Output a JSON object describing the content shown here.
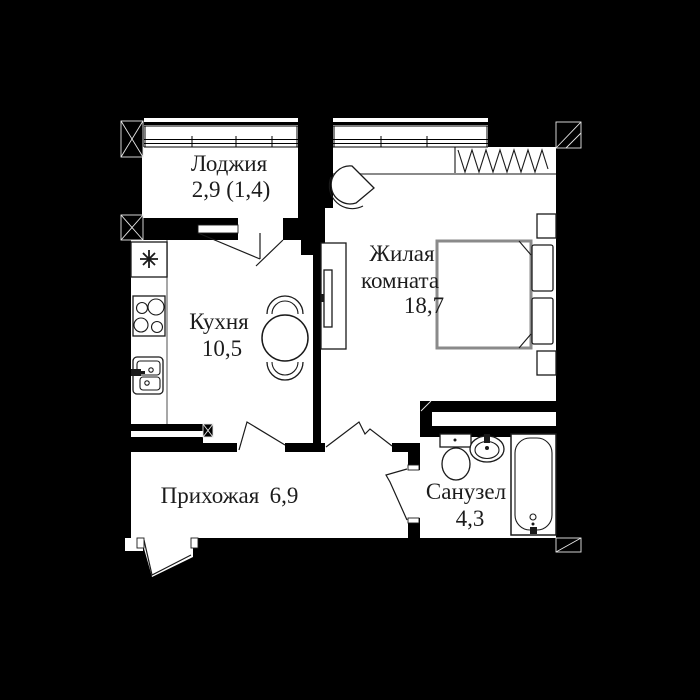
{
  "rooms": [
    {
      "id": "loggia",
      "label": "Лоджия",
      "area": "2,9 (1,4)"
    },
    {
      "id": "kitchen",
      "label": "Кухня",
      "area": "10,5"
    },
    {
      "id": "living_room",
      "label_lines": [
        "Жилая",
        "комната"
      ],
      "area": "18,7"
    },
    {
      "id": "hallway",
      "label": "Прихожая",
      "area": "6,9"
    },
    {
      "id": "bathroom",
      "label": "Санузел",
      "area": "4,3"
    }
  ],
  "colors": {
    "background": "#000000",
    "floor": "#ffffff",
    "walls": "#000000",
    "furniture_line": "#1a1a1a",
    "bed_outline": "#8a8a8a",
    "text": "#1c1c1c"
  },
  "fixtures": [
    "balcony-window",
    "balcony-door",
    "wardrobe-hangers",
    "bed",
    "pillow",
    "nightstand",
    "tv-stand",
    "armchair",
    "dining-table",
    "chair",
    "stove",
    "kitchen-sink",
    "ventilation-shaft",
    "toilet",
    "washbasin",
    "bathtub",
    "entrance-door",
    "interior-door"
  ]
}
